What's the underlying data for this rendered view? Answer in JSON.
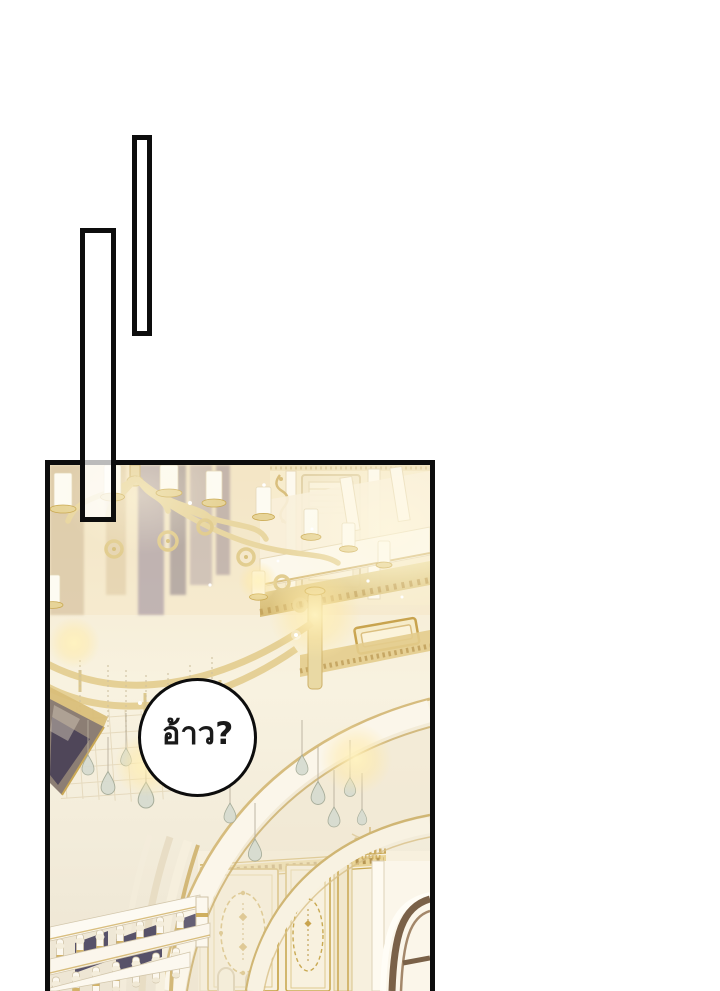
{
  "canvas": {
    "width": 720,
    "height": 991,
    "background": "#ffffff"
  },
  "palette": {
    "ink": "#0d0d0d",
    "paper": "#ffffff",
    "cream": "#f6ecd1",
    "cream_light": "#faf4e3",
    "gold": "#e6d29a",
    "gold_deep": "#c9a44e",
    "gold_line": "#d4ba7c",
    "white_warm": "#fcf8ee",
    "taupe": "#96879a",
    "navy": "#4a4460",
    "brown": "#7a6148",
    "crystal": "#d6dbd0",
    "glow": "#ffeeab",
    "banner": "#8c7e74"
  },
  "speech_bubble": {
    "text": "อ้าว?",
    "shape": "circle",
    "fill": "#ffffff",
    "stroke": "#111111"
  },
  "scene": {
    "type": "manhwa-panel",
    "setting": "ornate palace great hall",
    "elements": [
      "gilded chandelier with white candles",
      "hanging crystal teardrops",
      "grand white arches with gold trim",
      "balcony with gold bands and framed plaque",
      "staircase balustrade with navy accents",
      "paneled wall with gold oval wreaths",
      "dark wooden door frame",
      "warm candle glows and sparkles"
    ]
  },
  "dividers": [
    {
      "id": "right",
      "style": "tall thin outlined rectangle"
    },
    {
      "id": "left",
      "style": "tall outlined rectangle overlapping panel"
    }
  ]
}
